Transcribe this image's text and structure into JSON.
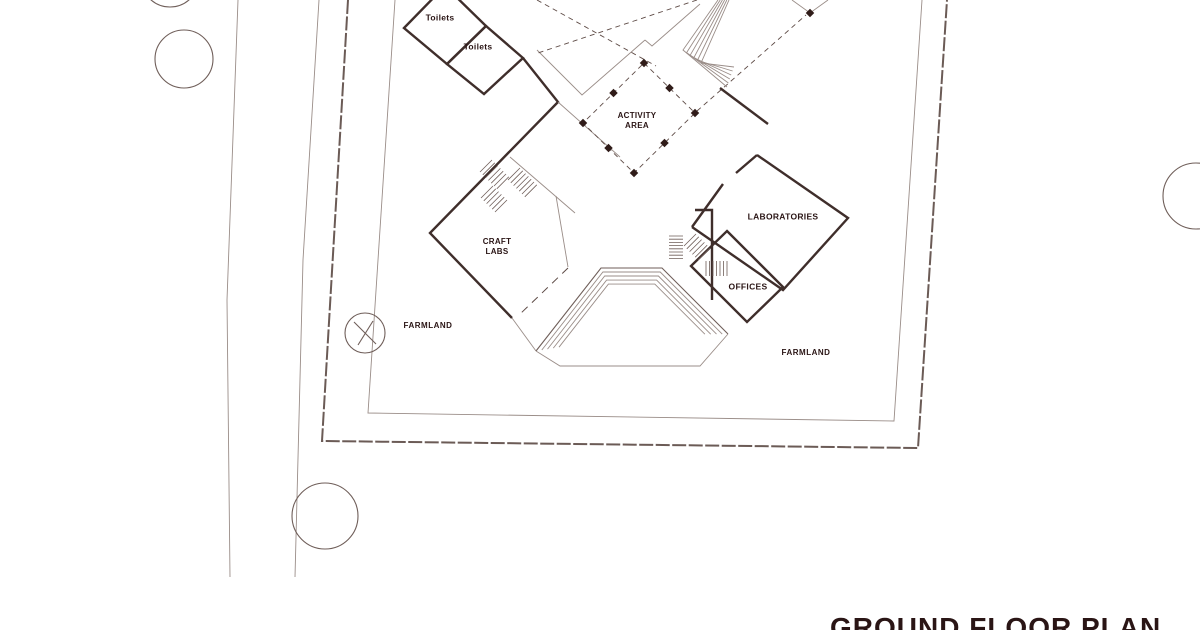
{
  "title": "GROUND FLOOR PLAN",
  "plan": {
    "room_labels": {
      "toilets_1": "Toilets",
      "toilets_2": "Toilets",
      "activity_area": "ACTIVITY\nAREA",
      "craft_labs": "CRAFT\nLABS",
      "laboratories": "LABORATORIES",
      "offices": "OFFICES"
    },
    "site_labels": {
      "farmland_left": "FARMLAND",
      "farmland_right": "FARMLAND"
    },
    "legend": {
      "trees": 5,
      "drawing_type": "architectural site / floor plan"
    }
  },
  "colors": {
    "wall": "#3f2e2b",
    "thin_line": "#9a8d88",
    "medium_line": "#6f5e59",
    "boundary": "#6b5b56",
    "dash_line": "#5d4a45",
    "dot": "#301c19",
    "text": "#2a1515",
    "background": "#ffffff"
  }
}
